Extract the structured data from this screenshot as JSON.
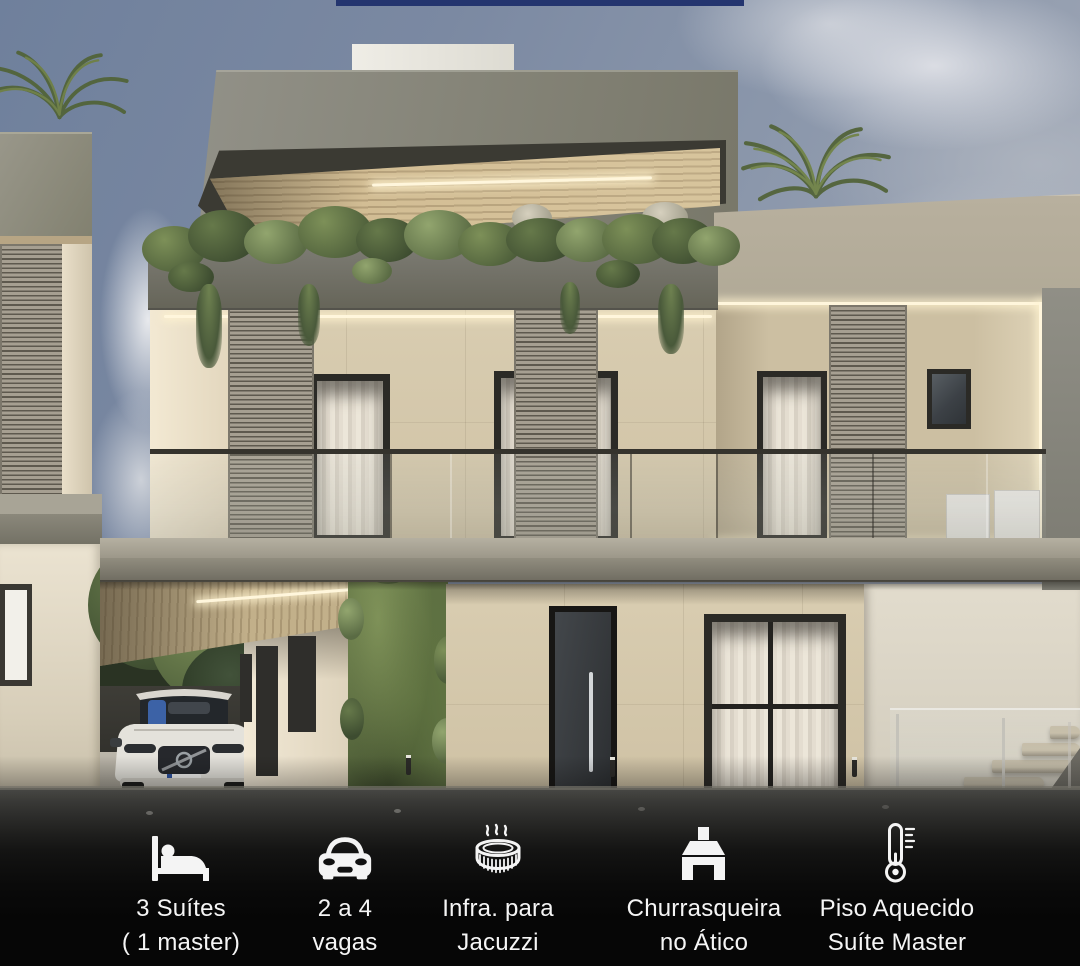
{
  "features": [
    {
      "icon": "bed-icon",
      "line1": "3 Suítes",
      "line2": "( 1 master)"
    },
    {
      "icon": "car-icon",
      "line1": "2 a 4",
      "line2": "vagas"
    },
    {
      "icon": "jacuzzi-icon",
      "line1": "Infra. para",
      "line2": "Jacuzzi"
    },
    {
      "icon": "barbecue-icon",
      "line1": "Churrasqueira",
      "line2": "no Ático"
    },
    {
      "icon": "thermometer-icon",
      "line1": "Piso Aquecido",
      "line2": "Suíte Master"
    }
  ],
  "colors": {
    "top_bar_navy": "#24356f",
    "sky": "#8693a9",
    "concrete_gray": "#86857a",
    "travertine_beige": "#d5c8ac",
    "greenery": "#5e7042",
    "led_warm_white": "#fff6dc",
    "caption_text": "#f5f5f5",
    "caption_background": "#060606"
  }
}
